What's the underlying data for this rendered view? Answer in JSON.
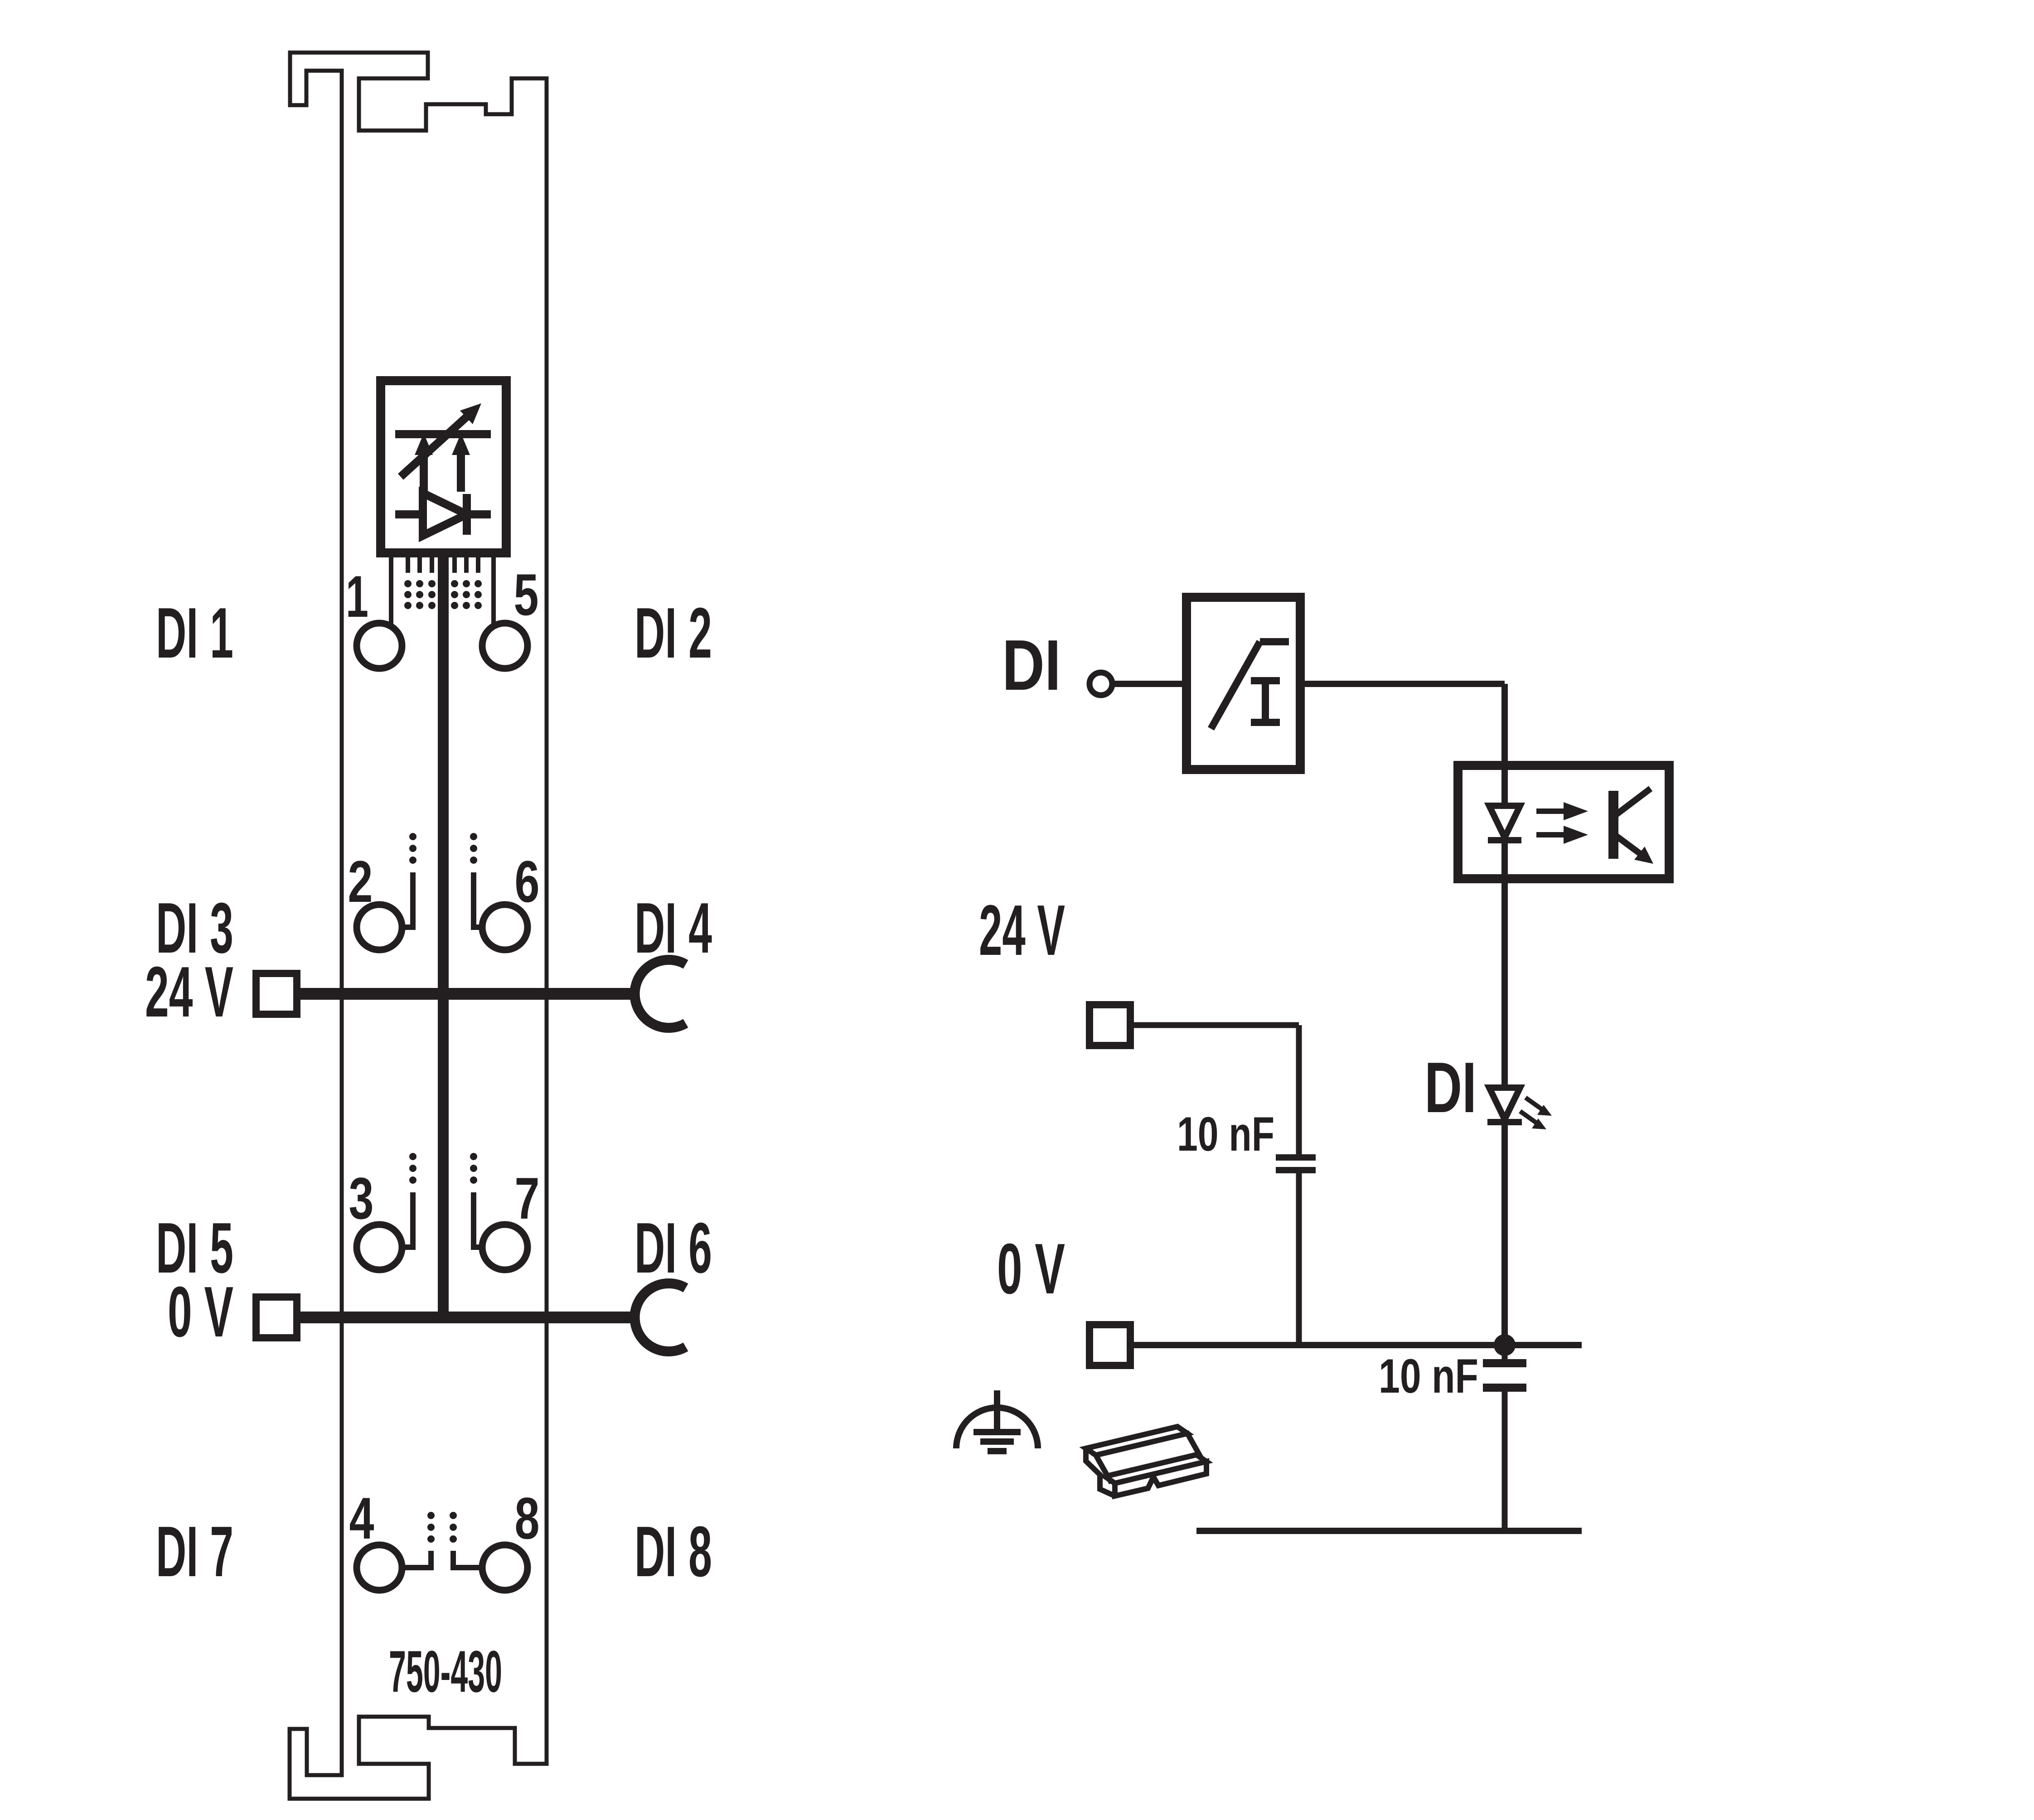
{
  "colors": {
    "ink": "#231f20",
    "background": "#ffffff"
  },
  "module": {
    "part_number": "750-430",
    "channel_labels": {
      "di1": "DI 1",
      "di2": "DI 2",
      "di3": "DI 3",
      "di4": "DI 4",
      "di5": "DI 5",
      "di6": "DI 6",
      "di7": "DI 7",
      "di8": "DI 8"
    },
    "supply_labels": {
      "v24": "24 V",
      "v0": "0 V"
    },
    "contact_numbers": [
      "1",
      "2",
      "3",
      "4",
      "5",
      "6",
      "7",
      "8"
    ]
  },
  "circuit": {
    "input_label": "DI",
    "supply_24v_label": "24 V",
    "supply_0v_label": "0 V",
    "led_label": "DI",
    "capacitor_top_label": "10 nF",
    "capacitor_bottom_label": "10 nF"
  }
}
